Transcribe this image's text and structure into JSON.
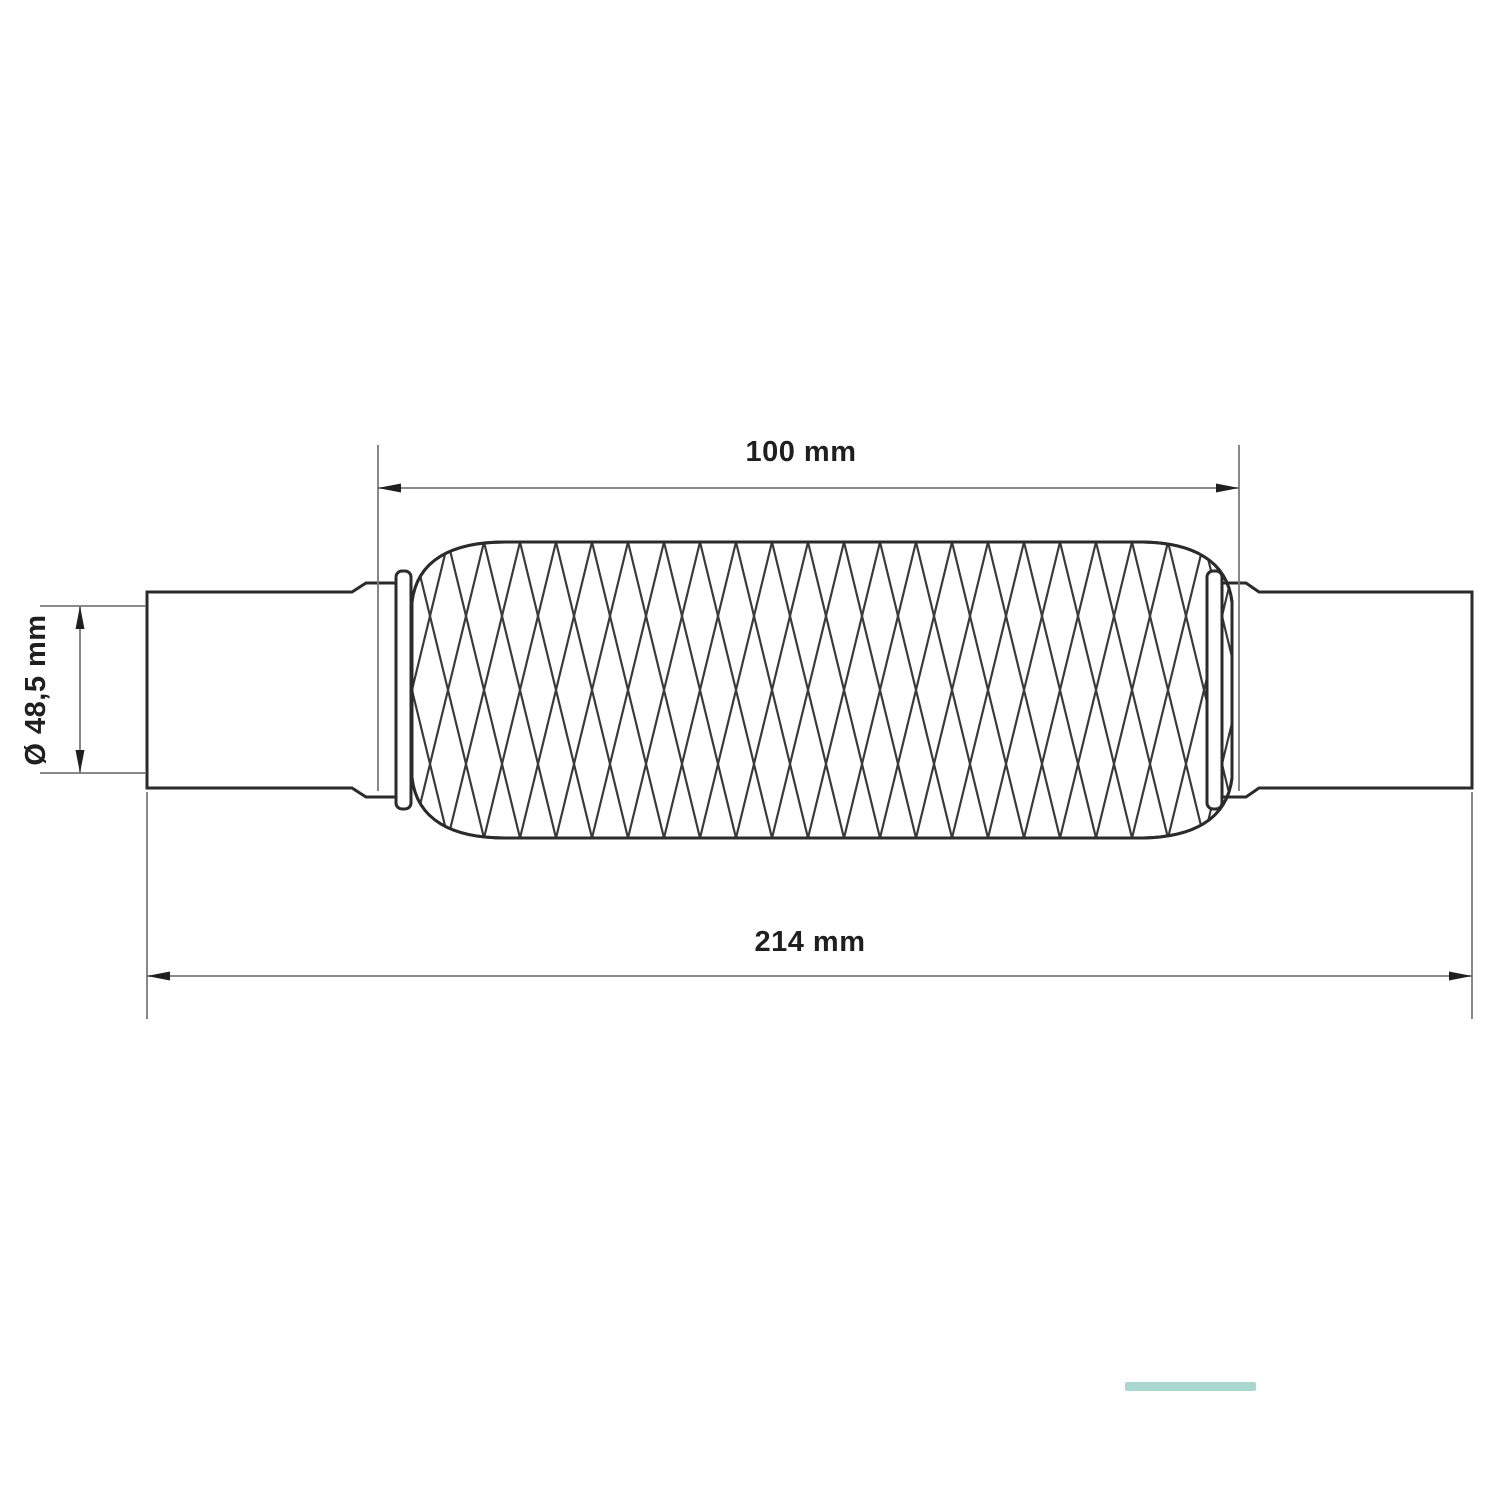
{
  "drawing": {
    "kind": "technical-dimension-drawing",
    "subject": "exhaust-flex-pipe-with-braided-sleeve",
    "labels": {
      "braid_length": "100 mm",
      "total_length": "214 mm",
      "diameter": "Ø 48,5 mm"
    },
    "colors": {
      "outline": "#2b2b2b",
      "mesh": "#3a3a3a",
      "dimension_line": "#7a7a7a",
      "text": "#1f1f1f",
      "background": "#ffffff",
      "accent_strip": "#abd7d1"
    }
  }
}
